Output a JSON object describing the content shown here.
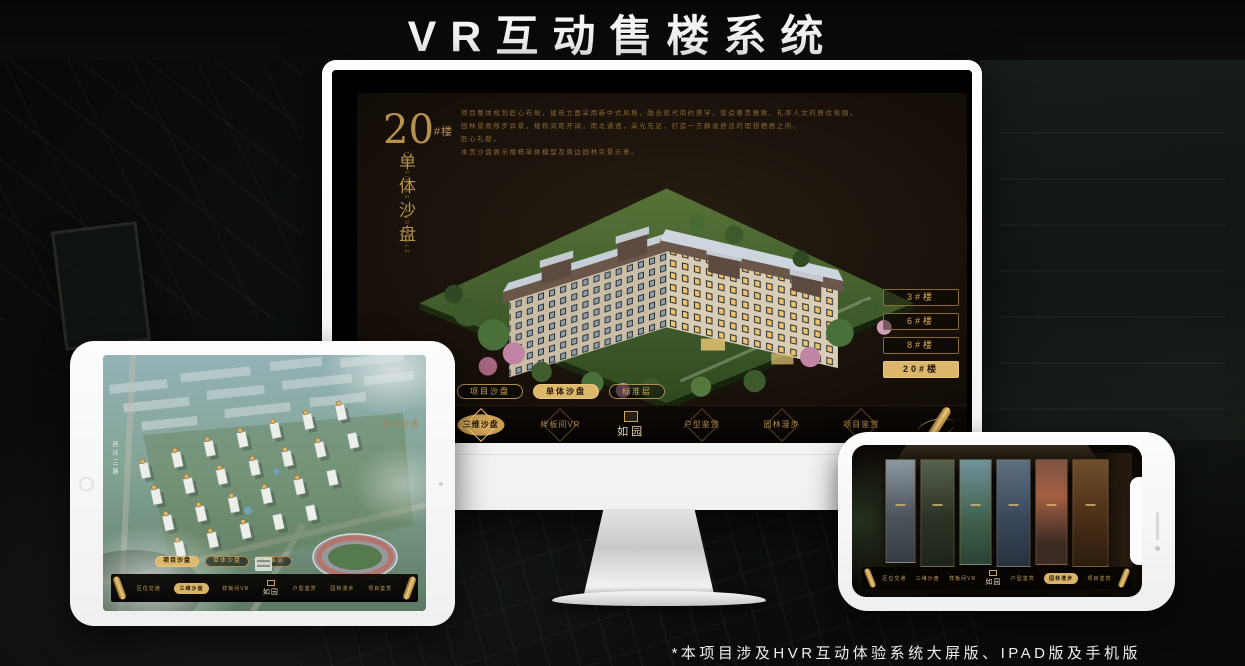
{
  "page": {
    "title": "VR互动售楼系统",
    "footnote": "*本项目涉及HVR互动体验系统大屏版、IPAD版及手机版"
  },
  "colors": {
    "gold": "#d8b36a",
    "gold_dark": "#8a6a35",
    "active_text": "#241806",
    "screen_bg": "#160f09"
  },
  "brand": {
    "logo_text": "如园"
  },
  "monitor": {
    "headline": {
      "number": "20",
      "suffix": "#楼",
      "vertical": "单体沙盘",
      "vertical_en": "THE SINGLE SAND TABLE"
    },
    "description_lines": [
      "项目整体规划匠心布局，建筑立面采用新中式风格，融合现代简约美学，营造尊贵雅致、礼序人文的居住氛围。",
      "园林景观移步异景，楼栋间距开阔，南北通透，采光充足，打造一方静谧舒适的理想栖居之所。",
      "匠心礼献。",
      "本页沙盘展示楼栋单体模型及周边园林实景示意。"
    ],
    "floor_buttons": [
      {
        "label": "3#楼",
        "active": false
      },
      {
        "label": "6#楼",
        "active": false
      },
      {
        "label": "8#楼",
        "active": false
      },
      {
        "label": "20#楼",
        "active": true
      }
    ],
    "sub_tabs": [
      {
        "label": "项目沙盘",
        "active": false
      },
      {
        "label": "单体沙盘",
        "active": true
      },
      {
        "label": "标准层",
        "active": false
      }
    ],
    "nav_items": [
      {
        "label": "区位交通",
        "active": false
      },
      {
        "label": "三维沙盘",
        "active": true
      },
      {
        "label": "样板间VR",
        "active": false
      },
      {
        "label": "户型鉴赏",
        "active": false
      },
      {
        "label": "园林漫步",
        "active": false
      },
      {
        "label": "项目鉴赏",
        "active": false
      }
    ]
  },
  "tablet": {
    "road_label": "西环三路",
    "sub_tabs": [
      {
        "label": "项目沙盘",
        "active": true
      },
      {
        "label": "单体沙盘",
        "active": false
      },
      {
        "label": "标准层",
        "active": false
      }
    ],
    "nav_items": [
      {
        "label": "区位交通",
        "active": false
      },
      {
        "label": "三维沙盘",
        "active": true
      },
      {
        "label": "样板间VR",
        "active": false
      },
      {
        "label": "户型鉴赏",
        "active": false
      },
      {
        "label": "园林漫步",
        "active": false
      },
      {
        "label": "项目鉴赏",
        "active": false
      }
    ]
  },
  "phone": {
    "nav_items": [
      {
        "label": "区位交通",
        "active": false
      },
      {
        "label": "三维沙盘",
        "active": false
      },
      {
        "label": "样板间VR",
        "active": false
      },
      {
        "label": "户型鉴赏",
        "active": false
      },
      {
        "label": "园林漫步",
        "active": true
      },
      {
        "label": "项目鉴赏",
        "active": false
      }
    ]
  }
}
